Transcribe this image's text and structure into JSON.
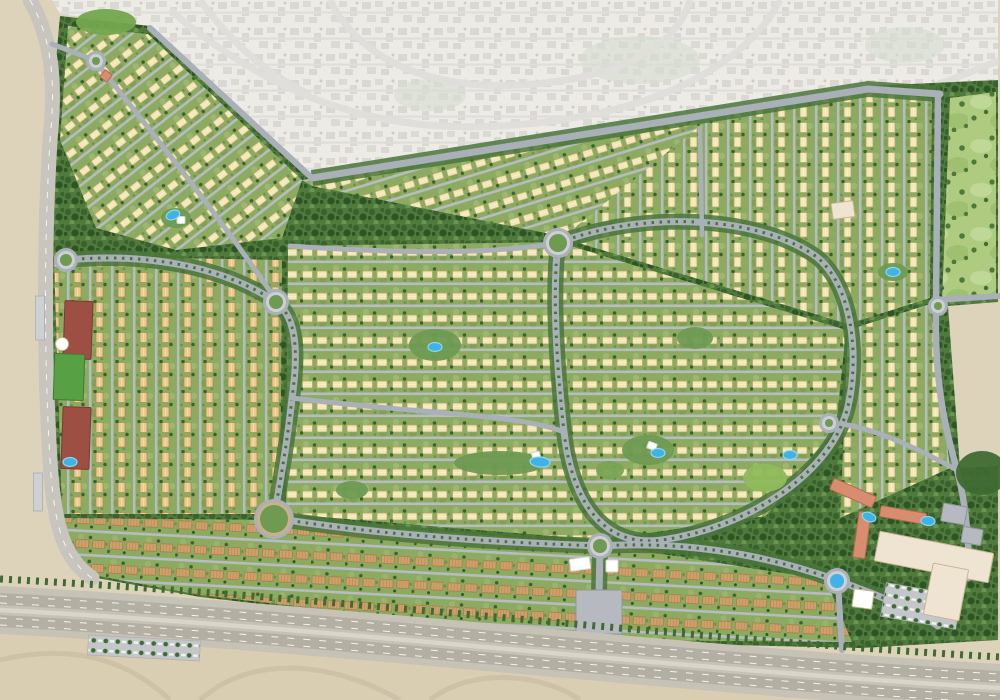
{
  "map": {
    "canvas": {
      "w": 1000,
      "h": 700
    },
    "palette": {
      "sand": "#ddd3bb",
      "sandDeep": "#d9cdb2",
      "contextBase": "#e9e7e1",
      "contextBlock": "#cfcdc7",
      "contextRoad": "#d9d7d2",
      "beltGreen": "#4f7a3c",
      "beltDot1": "#3a612e",
      "beltDot2": "#699550",
      "beltDark": "#2e5526",
      "ground": "#8cab60",
      "groundLight": "#a2bd76",
      "groundDark": "#77994f",
      "villaCream": "#f2e7b6",
      "villaCreamEdge": "#b8a268",
      "villaTan": "#ecca8e",
      "villaTanEdge": "#b08a50",
      "townBrown": "#cfa06c",
      "townRoof": "#a97b47",
      "road": "#a9b0b8",
      "roadMinor": "#b6bcc2",
      "roadLight": "#c8c5be",
      "roadRing": "#ccd0d4",
      "corridor": "#4a7539",
      "median": "#3f6b33",
      "golf": "#aecb80",
      "golfLight": "#c0d897",
      "golfBlob": "#9fc070",
      "golfTree": "#4d7a3b",
      "pool": "#3fb3e6",
      "poolLight": "#8ed7f4",
      "maroon": "#9e4f44",
      "maroonEdge": "#7c3a32",
      "field": "#58a044",
      "fieldEdge": "#3f7c33",
      "terracotta": "#d98d70",
      "terracottaEdge": "#b56c50",
      "mallCream": "#efe4d2",
      "mallEdge": "#c9b492",
      "grayBldg": "#b6bac0",
      "grayBldgEdge": "#8f959b",
      "highway": "#c7c2b6",
      "highwayLane": "#b4afa3",
      "highwayMedian": "#d9d5c9",
      "rampSand": "#cdc1a7",
      "white": "#ffffff"
    },
    "devOutline": [
      [
        60,
        16
      ],
      [
        150,
        26
      ],
      [
        312,
        176
      ],
      [
        868,
        86
      ],
      [
        998,
        80
      ],
      [
        998,
        302
      ],
      [
        948,
        306
      ],
      [
        960,
        468
      ],
      [
        998,
        466
      ],
      [
        998,
        640
      ],
      [
        862,
        648
      ],
      [
        600,
        642
      ],
      [
        400,
        620
      ],
      [
        200,
        597
      ],
      [
        86,
        576
      ],
      [
        56,
        520
      ],
      [
        46,
        420
      ],
      [
        42,
        300
      ],
      [
        46,
        160
      ],
      [
        56,
        60
      ]
    ],
    "context": {
      "pts": [
        [
          52,
          0
        ],
        [
          998,
          0
        ],
        [
          998,
          80
        ],
        [
          868,
          86
        ],
        [
          312,
          176
        ],
        [
          150,
          26
        ],
        [
          60,
          14
        ]
      ],
      "roads": [
        "M170,10 C300,120 420,140 560,120 C700,100 760,40 780,0",
        "M330,0 C360,60 430,90 520,85 C640,78 680,35 690,0",
        "M700,120 C800,130 880,110 1000,60",
        "M200,0 C230,40 260,70 310,95"
      ],
      "greens": [
        {
          "x": 640,
          "y": 60,
          "rx": 60,
          "ry": 24
        },
        {
          "x": 905,
          "y": 45,
          "rx": 40,
          "ry": 18
        },
        {
          "x": 430,
          "y": 95,
          "rx": 36,
          "ry": 16
        }
      ]
    },
    "districts": [
      {
        "name": "nw-villas",
        "pattern": "villa",
        "house": "cream",
        "rot": -38,
        "pts": [
          [
            68,
            26
          ],
          [
            148,
            34
          ],
          [
            302,
            180
          ],
          [
            282,
            238
          ],
          [
            176,
            250
          ],
          [
            96,
            228
          ],
          [
            60,
            140
          ]
        ]
      },
      {
        "name": "north-band-villas",
        "pattern": "villa",
        "house": "cream",
        "rot": -17,
        "pts": [
          [
            302,
            180
          ],
          [
            640,
            128
          ],
          [
            704,
            122
          ],
          [
            706,
            188
          ],
          [
            560,
            236
          ],
          [
            312,
            186
          ]
        ]
      },
      {
        "name": "ne-villas",
        "pattern": "villa",
        "house": "cream",
        "rot": 90,
        "pts": [
          [
            640,
            128
          ],
          [
            866,
            92
          ],
          [
            932,
            98
          ],
          [
            930,
            298
          ],
          [
            848,
            324
          ],
          [
            562,
            238
          ],
          [
            702,
            124
          ]
        ]
      },
      {
        "name": "center-villas",
        "pattern": "villa",
        "house": "cream",
        "rot": 0,
        "pts": [
          [
            288,
            246
          ],
          [
            558,
            242
          ],
          [
            846,
            330
          ],
          [
            836,
            428
          ],
          [
            766,
            516
          ],
          [
            600,
            540
          ],
          [
            286,
            514
          ]
        ]
      },
      {
        "name": "west-villas",
        "pattern": "villa",
        "house": "tan",
        "rot": 90,
        "pts": [
          [
            54,
            256
          ],
          [
            282,
            260
          ],
          [
            280,
            514
          ],
          [
            62,
            514
          ]
        ]
      },
      {
        "name": "east-villas",
        "pattern": "villa",
        "house": "cream",
        "rot": 90,
        "pts": [
          [
            848,
            330
          ],
          [
            930,
            304
          ],
          [
            950,
            468
          ],
          [
            840,
            518
          ]
        ]
      },
      {
        "name": "golf-course",
        "pattern": "golf",
        "rot": 0,
        "pts": [
          [
            950,
            98
          ],
          [
            996,
            92
          ],
          [
            996,
            298
          ],
          [
            942,
            302
          ]
        ]
      },
      {
        "name": "south-townhomes",
        "pattern": "town",
        "rot": 3,
        "pts": [
          [
            64,
            518
          ],
          [
            286,
            520
          ],
          [
            600,
            544
          ],
          [
            826,
            580
          ],
          [
            852,
            642
          ],
          [
            600,
            640
          ],
          [
            400,
            618
          ],
          [
            200,
            595
          ],
          [
            88,
            574
          ],
          [
            56,
            520
          ]
        ]
      },
      {
        "name": "se-amenity-green",
        "pattern": "belt",
        "rot": 0,
        "pts": [
          [
            838,
            520
          ],
          [
            952,
            470
          ],
          [
            996,
            468
          ],
          [
            996,
            638
          ],
          [
            864,
            646
          ],
          [
            830,
            582
          ]
        ]
      }
    ],
    "roads": [
      {
        "name": "left-corner-road",
        "d": "M30,0 C52,40 56,80 50,140 C44,240 44,360 50,460 C54,528 64,558 92,578",
        "w": 15,
        "c": "roadLight",
        "lane": true
      },
      {
        "name": "top-boundary-road",
        "d": "M312,178 L868,89 L940,94",
        "w": 7,
        "c": "road",
        "corridor": true
      },
      {
        "name": "nw-edge-road",
        "d": "M150,28 L312,178",
        "w": 6,
        "c": "road"
      },
      {
        "name": "east-perimeter-road",
        "d": "M938,96 L936,304 C934,386 946,430 957,470 C965,500 970,540 968,578",
        "w": 6.5,
        "c": "road"
      },
      {
        "name": "east-exit-road",
        "d": "M936,300 L1000,296",
        "w": 6,
        "c": "road"
      },
      {
        "name": "central-loop-road",
        "d": "M558,243 C650,208 765,218 818,258 C862,296 858,390 842,424 C820,478 745,528 662,540 C602,548 572,500 564,432 C557,368 552,295 558,243 Z",
        "w": 7,
        "c": "road",
        "median": true,
        "corridor": true
      },
      {
        "name": "west-loop-road",
        "d": "M66,260 C150,252 225,268 276,302 C298,318 298,356 292,398 C287,445 280,482 274,518",
        "w": 7,
        "c": "road",
        "median": true,
        "corridor": true
      },
      {
        "name": "south-avenue",
        "d": "M274,518 C380,535 490,542 600,546 C700,540 780,560 836,580 C880,596 916,610 938,626",
        "w": 7,
        "c": "road",
        "median": true,
        "corridor": true
      },
      {
        "name": "south-entry-road",
        "d": "M600,548 L598,640",
        "w": 7,
        "c": "road",
        "corridor": true
      },
      {
        "name": "se-entry-road",
        "d": "M838,582 L842,650",
        "w": 6,
        "c": "road"
      },
      {
        "name": "nw-spine-road",
        "d": "M96,62 C150,130 215,210 276,300",
        "w": 5,
        "c": "road"
      },
      {
        "name": "nw-entry-road",
        "d": "M52,44 C72,52 84,56 96,61",
        "w": 5,
        "c": "road"
      },
      {
        "name": "mid-collector-road",
        "d": "M292,398 C420,414 520,414 564,432",
        "w": 5,
        "c": "road"
      },
      {
        "name": "north-collector-road",
        "d": "M290,246 C380,252 480,256 558,243",
        "w": 5,
        "c": "road"
      },
      {
        "name": "ne-collector-road",
        "d": "M700,128 L702,235",
        "w": 4.5,
        "c": "road"
      },
      {
        "name": "se-loop-road",
        "d": "M842,424 C880,430 920,450 957,470",
        "w": 5,
        "c": "road"
      }
    ],
    "roundabouts": [
      {
        "x": 96,
        "y": 61,
        "r": 7
      },
      {
        "x": 558,
        "y": 243,
        "r": 12
      },
      {
        "x": 276,
        "y": 302,
        "r": 10
      },
      {
        "x": 66,
        "y": 260,
        "r": 9
      },
      {
        "x": 274,
        "y": 519,
        "r": 17,
        "tan": true
      },
      {
        "x": 600,
        "y": 546,
        "r": 10
      },
      {
        "x": 837,
        "y": 581,
        "r": 10,
        "fountain": true
      },
      {
        "x": 829,
        "y": 423,
        "r": 7
      },
      {
        "x": 938,
        "y": 306,
        "r": 7
      }
    ],
    "parks": [
      {
        "x": 106,
        "y": 22,
        "rx": 30,
        "ry": 13,
        "c": "#74a74e"
      },
      {
        "x": 435,
        "y": 345,
        "rx": 26,
        "ry": 16,
        "c": "#6f9a52"
      },
      {
        "x": 500,
        "y": 463,
        "rx": 46,
        "ry": 12,
        "c": "#6f9a52"
      },
      {
        "x": 648,
        "y": 450,
        "rx": 26,
        "ry": 15,
        "c": "#6f9a52"
      },
      {
        "x": 765,
        "y": 478,
        "rx": 22,
        "ry": 14,
        "c": "#8fba5c"
      },
      {
        "x": 695,
        "y": 338,
        "rx": 18,
        "ry": 11,
        "c": "#6f9a52"
      },
      {
        "x": 893,
        "y": 272,
        "rx": 15,
        "ry": 9,
        "c": "#6f9a52"
      },
      {
        "x": 176,
        "y": 218,
        "rx": 15,
        "ry": 10,
        "c": "#6f9a52"
      },
      {
        "x": 982,
        "y": 473,
        "rx": 26,
        "ry": 22,
        "c": "#3f6b33"
      },
      {
        "x": 352,
        "y": 490,
        "rx": 16,
        "ry": 9,
        "c": "#6f9a52"
      },
      {
        "x": 610,
        "y": 470,
        "rx": 14,
        "ry": 9,
        "c": "#79a355"
      }
    ],
    "buildings": [
      {
        "name": "school-building",
        "x": 78,
        "y": 330,
        "w": 28,
        "h": 58,
        "rot": 2,
        "f": "maroon",
        "s": "maroonEdge"
      },
      {
        "name": "school-building",
        "x": 76,
        "y": 438,
        "w": 28,
        "h": 62,
        "rot": 2,
        "f": "maroon",
        "s": "maroonEdge"
      },
      {
        "name": "sports-field",
        "x": 69,
        "y": 377,
        "w": 30,
        "h": 46,
        "rot": 2,
        "f": "field",
        "s": "fieldEdge"
      },
      {
        "name": "community-dome",
        "x": 62,
        "y": 344,
        "w": 13,
        "h": 13,
        "rot": 0,
        "f": "white",
        "s": "mallEdge",
        "round": true
      },
      {
        "name": "school-building",
        "x": 599,
        "y": 612,
        "w": 46,
        "h": 44,
        "rot": 0,
        "f": "grayBldg",
        "s": "grayBldgEdge"
      },
      {
        "name": "canopy-structure",
        "x": 580,
        "y": 564,
        "w": 20,
        "h": 12,
        "rot": -8,
        "f": "white",
        "s": "contextRoad"
      },
      {
        "name": "canopy-structure",
        "x": 612,
        "y": 566,
        "w": 12,
        "h": 12,
        "rot": 0,
        "f": "white",
        "s": "contextRoad"
      },
      {
        "name": "mosque",
        "x": 863,
        "y": 599,
        "w": 20,
        "h": 18,
        "rot": 8,
        "f": "white",
        "s": "mallEdge"
      },
      {
        "name": "apartment-building",
        "x": 853,
        "y": 493,
        "w": 46,
        "h": 12,
        "rot": 24,
        "f": "terracotta",
        "s": "terracottaEdge"
      },
      {
        "name": "apartment-building",
        "x": 862,
        "y": 535,
        "w": 12,
        "h": 46,
        "rot": 8,
        "f": "terracotta",
        "s": "terracottaEdge"
      },
      {
        "name": "apartment-building",
        "x": 903,
        "y": 515,
        "w": 46,
        "h": 11,
        "rot": 10,
        "f": "terracotta",
        "s": "terracottaEdge"
      },
      {
        "name": "office-building",
        "x": 954,
        "y": 514,
        "w": 24,
        "h": 18,
        "rot": 10,
        "f": "grayBldg",
        "s": "grayBldgEdge"
      },
      {
        "name": "office-building",
        "x": 972,
        "y": 536,
        "w": 20,
        "h": 16,
        "rot": 10,
        "f": "grayBldg",
        "s": "grayBldgEdge"
      },
      {
        "name": "mall-building",
        "x": 934,
        "y": 557,
        "w": 116,
        "h": 30,
        "rot": 11,
        "f": "mallCream",
        "s": "mallEdge"
      },
      {
        "name": "mall-building",
        "x": 946,
        "y": 592,
        "w": 36,
        "h": 52,
        "rot": 11,
        "f": "mallCream",
        "s": "mallEdge"
      },
      {
        "name": "landmark-pavilion",
        "x": 106,
        "y": 76,
        "w": 9,
        "h": 9,
        "rot": 40,
        "f": "terracotta",
        "s": "terracottaEdge"
      },
      {
        "name": "community-building",
        "x": 843,
        "y": 210,
        "w": 22,
        "h": 16,
        "rot": -8,
        "f": "mallCream",
        "s": "mallEdge"
      },
      {
        "name": "sail-pavilion",
        "x": 652,
        "y": 446,
        "w": 9,
        "h": 7,
        "rot": 20,
        "f": "white",
        "s": "contextRoad"
      },
      {
        "name": "sail-pavilion",
        "x": 536,
        "y": 455,
        "w": 8,
        "h": 6,
        "rot": -15,
        "f": "white",
        "s": "contextRoad"
      },
      {
        "name": "clubhouse",
        "x": 181,
        "y": 220,
        "w": 8,
        "h": 7,
        "rot": 0,
        "f": "white",
        "s": "contextRoad"
      }
    ],
    "pools": [
      {
        "x": 173,
        "y": 215,
        "rot": -20
      },
      {
        "x": 435,
        "y": 347,
        "rot": 0
      },
      {
        "x": 540,
        "y": 462,
        "rot": 5,
        "big": true
      },
      {
        "x": 658,
        "y": 453,
        "rot": 0
      },
      {
        "x": 790,
        "y": 455,
        "rot": 0
      },
      {
        "x": 893,
        "y": 272,
        "rot": 0
      },
      {
        "x": 869,
        "y": 517,
        "rot": 20
      },
      {
        "x": 928,
        "y": 521,
        "rot": 5
      },
      {
        "x": 70,
        "y": 462,
        "rot": 0
      }
    ],
    "parkingLots": [
      {
        "name": "mall-parking",
        "x": 921,
        "y": 606,
        "w": 76,
        "h": 34,
        "rot": 10,
        "pattern": true
      },
      {
        "name": "street-parking",
        "x": 40,
        "y": 318,
        "w": 9,
        "h": 44,
        "rot": 0,
        "pattern": false
      },
      {
        "name": "street-parking",
        "x": 38,
        "y": 492,
        "w": 9,
        "h": 38,
        "rot": 0,
        "pattern": false
      }
    ],
    "highway": {
      "body": "M0,586 C340,604 680,646 1000,664 L1000,712 C680,694 340,652 0,634 Z",
      "carriageways": [
        "M0,599 C340,617 680,659 1000,677",
        "M0,621 C340,639 680,681 1000,699"
      ],
      "median": "M0,610 C340,628 680,670 1000,688",
      "laneDashes": [
        "M0,596 C340,614 680,656 1000,674",
        "M0,603 C340,621 680,663 1000,681",
        "M0,618 C340,636 680,678 1000,696",
        "M0,625 C340,643 680,685 1000,703"
      ],
      "treeLine": "M0,579 C340,597 680,639 1000,657",
      "sandBelow": "M0,634 C340,652 680,694 1000,712 L1000,700 L0,700 Z",
      "ramps": [
        "M0,660 C60,646 120,652 170,700",
        "M200,700 C250,655 330,660 400,700",
        "M430,700 C470,668 540,672 580,700"
      ],
      "parkingStrip": {
        "x": 88,
        "y": 648,
        "w": 112,
        "h": 20,
        "rot": 3
      }
    }
  }
}
